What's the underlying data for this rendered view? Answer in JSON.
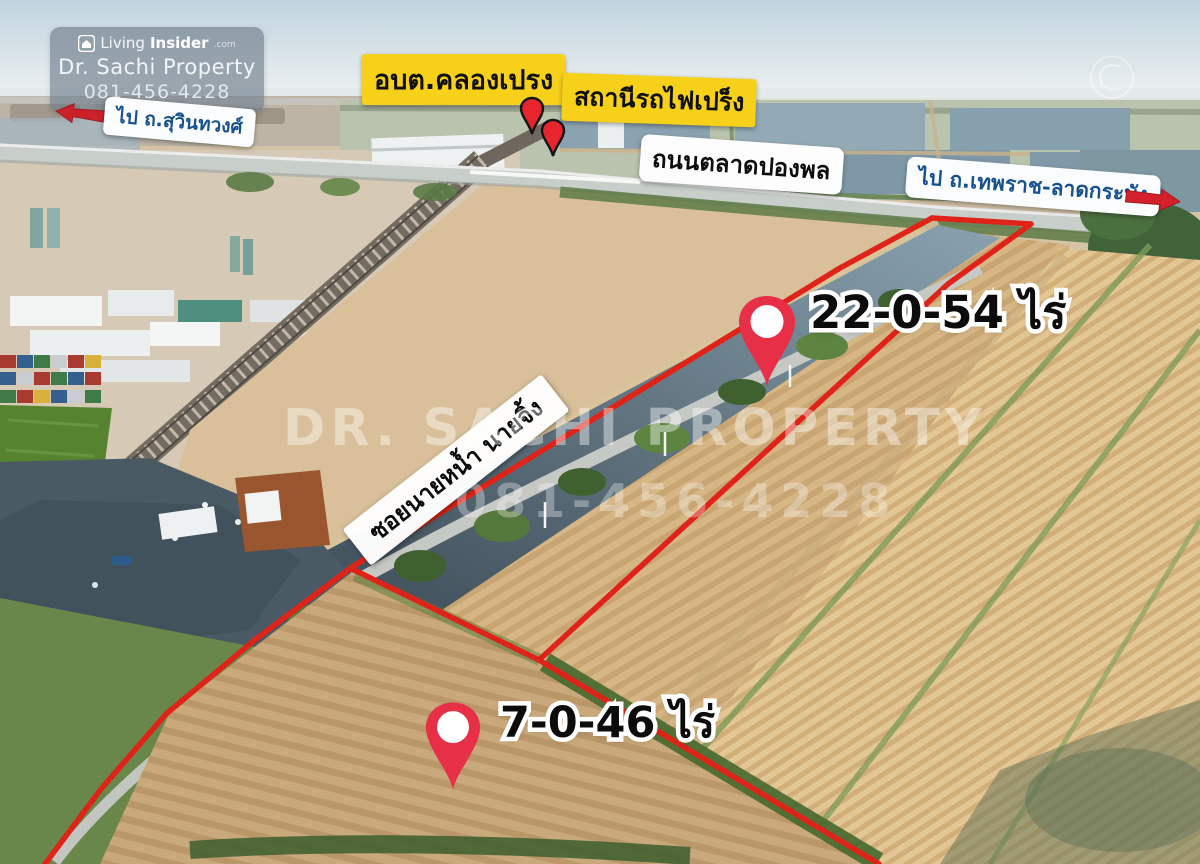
{
  "branding": {
    "logo_part1": "Living",
    "logo_part2": "Insider",
    "logo_tld": ".com",
    "agent_name": "Dr. Sachi Property",
    "agent_phone": "081-456-4228"
  },
  "labels": {
    "direction_left": "ไป ถ.สุวินทวงศ์",
    "subdistrict_office": "อบต.คลองเปรง",
    "train_station": "สถานีรถไฟเปร็ง",
    "road_name": "ถนนตลาดปองพล",
    "direction_right": "ไป ถ.เทพราช-ลาดกระบัง",
    "soi_sign": "ซอยนายหน้ำ นายจิ้ง",
    "plot_large_area": "22-0-54 ไร่",
    "plot_small_area": "7-0-46 ไร่",
    "copyright_mark": "©"
  },
  "watermark": {
    "title": "DR. SACHI PROPERTY",
    "phone": "081-456-4228"
  },
  "colors": {
    "boundary_red": "#df2318",
    "pin_red": "#e73048",
    "small_pin_red": "#e8242c",
    "label_yellow": "#f7d019",
    "direction_blue": "#17518f",
    "arrow_red": "#cb2128"
  }
}
